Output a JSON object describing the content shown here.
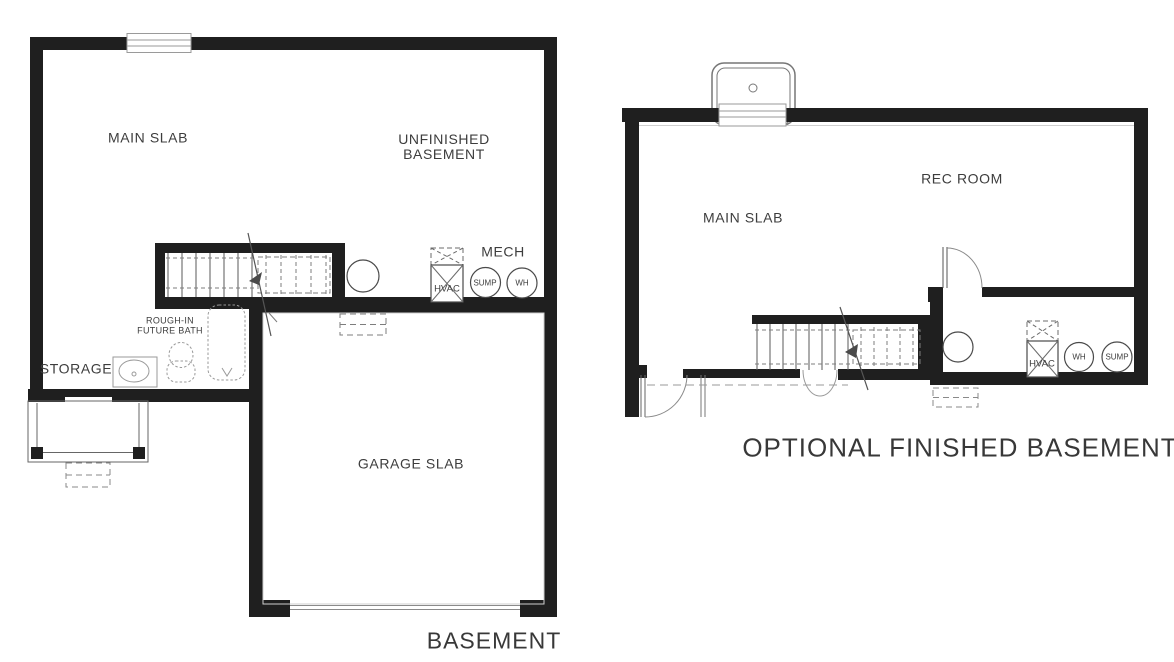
{
  "page": {
    "background": "#ffffff",
    "wall_color": "#1f1f1f",
    "text_color": "#3d3d3d",
    "fixture_line_color": "#9a9a9a"
  },
  "left_plan": {
    "labels": {
      "main_slab": "MAIN SLAB",
      "unfinished_basement_line1": "UNFINISHED",
      "unfinished_basement_line2": "BASEMENT",
      "mech": "MECH",
      "hvac": "HVAC",
      "sump": "SUMP",
      "wh": "WH",
      "rough_in_line1": "ROUGH-IN",
      "rough_in_line2": "FUTURE BATH",
      "storage": "STORAGE",
      "garage_slab": "GARAGE SLAB",
      "title": "BASEMENT"
    }
  },
  "right_plan": {
    "labels": {
      "rec_room": "REC ROOM",
      "main_slab": "MAIN SLAB",
      "hvac": "HVAC",
      "wh": "WH",
      "sump": "SUMP",
      "title": "OPTIONAL FINISHED BASEMENT"
    }
  }
}
